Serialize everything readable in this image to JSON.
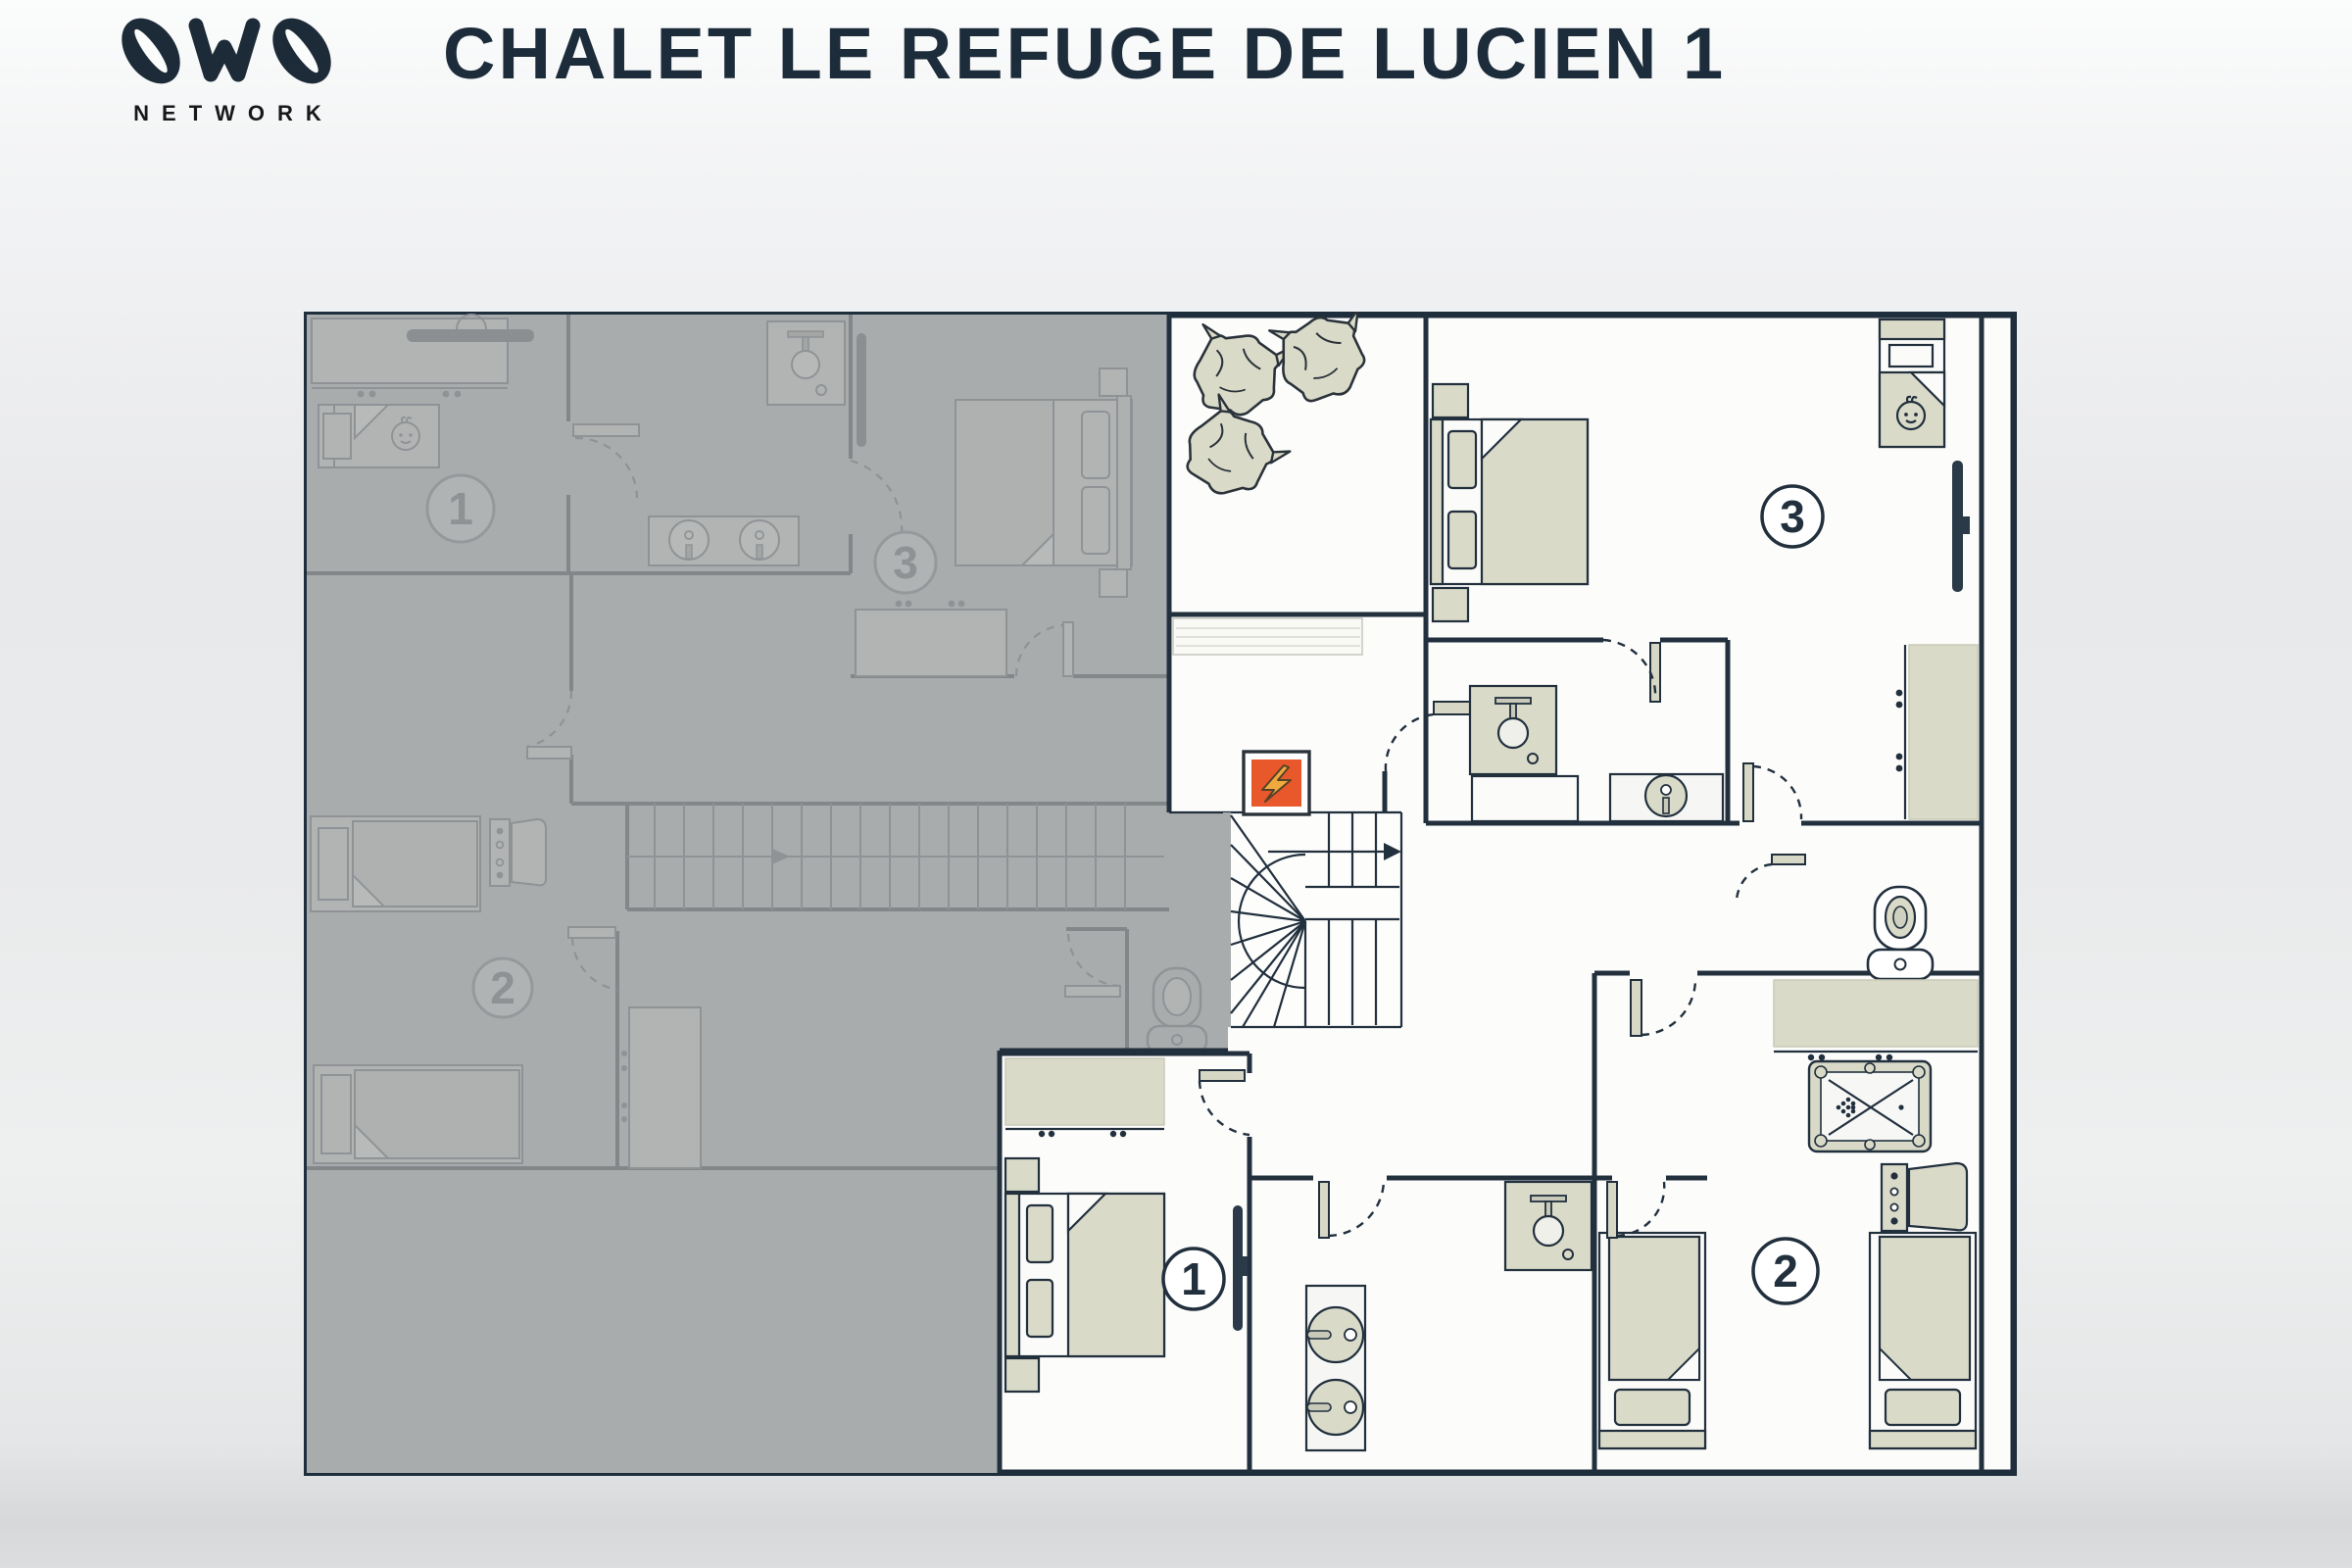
{
  "header": {
    "brand": {
      "network_label": "NETWORK"
    },
    "title": "CHALET LE REFUGE DE LUCIEN 1"
  },
  "plan": {
    "active_rooms": [
      {
        "number": "1",
        "type": "double bedroom"
      },
      {
        "number": "2",
        "type": "twin bedroom with pool table"
      },
      {
        "number": "3",
        "type": "double bedroom with baby cot"
      }
    ],
    "inactive_rooms": [
      {
        "number": "1",
        "type": "bedroom with baby cot (other floor, grayed)"
      },
      {
        "number": "2",
        "type": "twin bedroom (other floor, grayed)"
      },
      {
        "number": "3",
        "type": "double bedroom (other floor, grayed)"
      }
    ],
    "icons": [
      "lightning-icon",
      "baby-face-icon",
      "toilet-icon",
      "shower-icon",
      "sink-icon",
      "tv-icon",
      "bean-bag",
      "pool-table",
      "staircase",
      "door-swing-arc"
    ],
    "colors": {
      "wall": "#22303e",
      "furniture_beige": "#d9dac8",
      "inactive_gray": "#a9acad",
      "panel_orange": "#e8582b",
      "bolt_yellow": "#f0a93c",
      "title_navy": "#1d2c3a"
    }
  }
}
